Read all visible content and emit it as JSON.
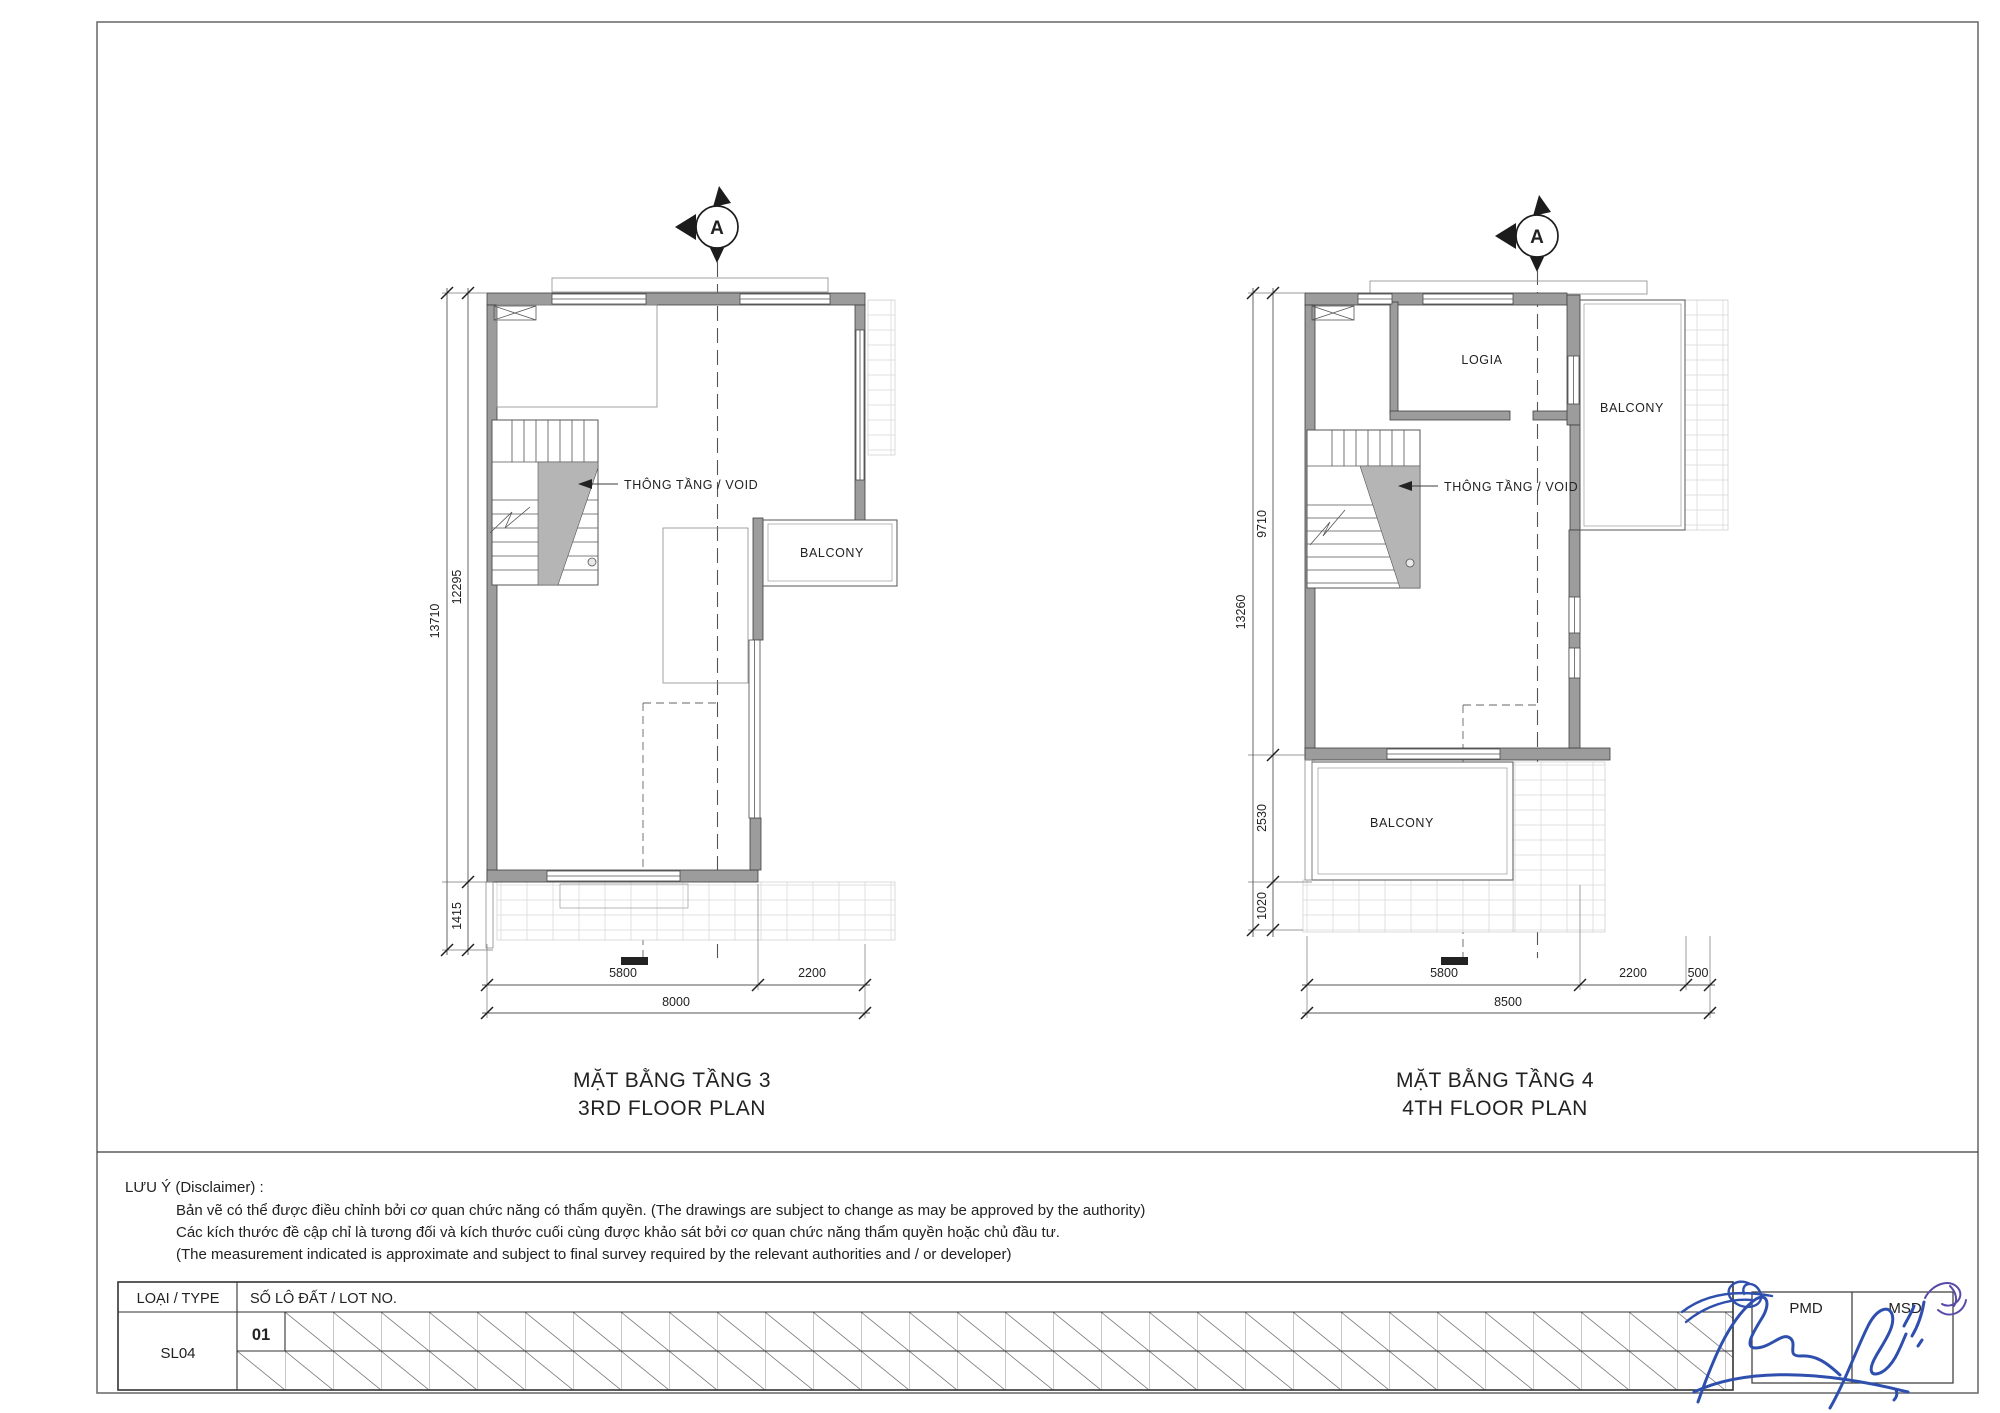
{
  "sheet": {
    "section_marker": "A",
    "disclaimer": {
      "heading": "LƯU Ý (Disclaimer) :",
      "line1": "Bản vẽ có thể được điều chỉnh bởi cơ quan chức năng có thẩm quyền. (The drawings are subject to change as may be approved by the authority)",
      "line2": "Các kích thước đề cập chỉ là tương đối và kích thước cuối cùng được khảo sát bởi cơ quan chức năng thẩm quyền hoặc chủ đầu tư.",
      "line3": "(The measurement indicated is approximate and subject to final survey required by the relevant authorities and / or developer)"
    },
    "title_block": {
      "type_label": "LOẠI / TYPE",
      "lot_label": "SỐ LÔ ĐẤT / LOT NO.",
      "type_value": "SL04",
      "lot_value": "01",
      "approver_left": "PMD",
      "approver_right": "MSD"
    },
    "colors": {
      "wall_gray": "#9c9c9c",
      "signature_blue": "#2e4fae",
      "signature_purple": "#5b49a8"
    }
  },
  "plan3": {
    "title_vi": "MẶT BẰNG TẦNG 3",
    "title_en": "3RD FLOOR PLAN",
    "labels": {
      "void": "THÔNG TẦNG / VOID",
      "balcony": "BALCONY"
    },
    "dims": {
      "total_height": "13710",
      "upper_height": "12295",
      "lower_height": "1415",
      "width_main": "5800",
      "width_right": "2200",
      "width_total": "8000"
    }
  },
  "plan4": {
    "title_vi": "MẶT BẰNG TẦNG 4",
    "title_en": "4TH FLOOR PLAN",
    "labels": {
      "void": "THÔNG TẦNG / VOID",
      "logia": "LOGIA",
      "balcony_top": "BALCONY",
      "balcony_bottom": "BALCONY"
    },
    "dims": {
      "total_height": "13260",
      "upper_height": "9710",
      "mid_height": "2530",
      "lower_height": "1020",
      "width_main": "5800",
      "width_right": "2200",
      "width_edge": "500",
      "width_total": "8500"
    }
  }
}
